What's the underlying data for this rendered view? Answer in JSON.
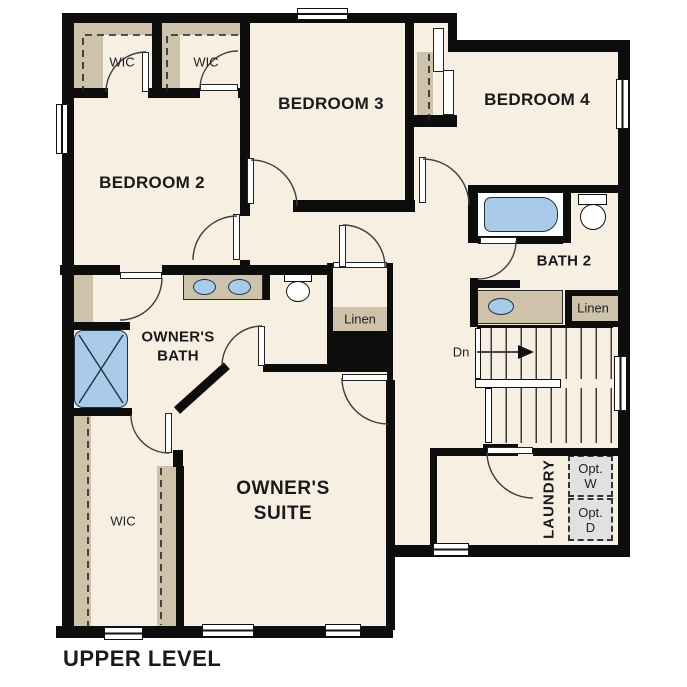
{
  "plan_title": "UPPER LEVEL",
  "colors": {
    "room_fill": "#f6efe2",
    "closet_fill": "#cec2ab",
    "fixture_blue": "#a9cae8",
    "optional_gray": "#e1e1e1",
    "wall": "#0d0d0d"
  },
  "labels": {
    "bedroom2": "BEDROOM 2",
    "bedroom3": "BEDROOM 3",
    "bedroom4": "BEDROOM 4",
    "bath2": "BATH 2",
    "owners_bath": {
      "line1": "OWNER'S",
      "line2": "BATH"
    },
    "owners_suite": {
      "line1": "OWNER'S",
      "line2": "SUITE"
    },
    "laundry": "LAUNDRY",
    "wic_bedroom2": "WIC",
    "wic_bedroom3": "WIC",
    "wic_owners": "WIC",
    "linen_hall": "Linen",
    "linen_bath2": "Linen",
    "stairs_down": "Dn",
    "opt_washer": {
      "line1": "Opt.",
      "line2": "W"
    },
    "opt_dryer": {
      "line1": "Opt.",
      "line2": "D"
    }
  }
}
